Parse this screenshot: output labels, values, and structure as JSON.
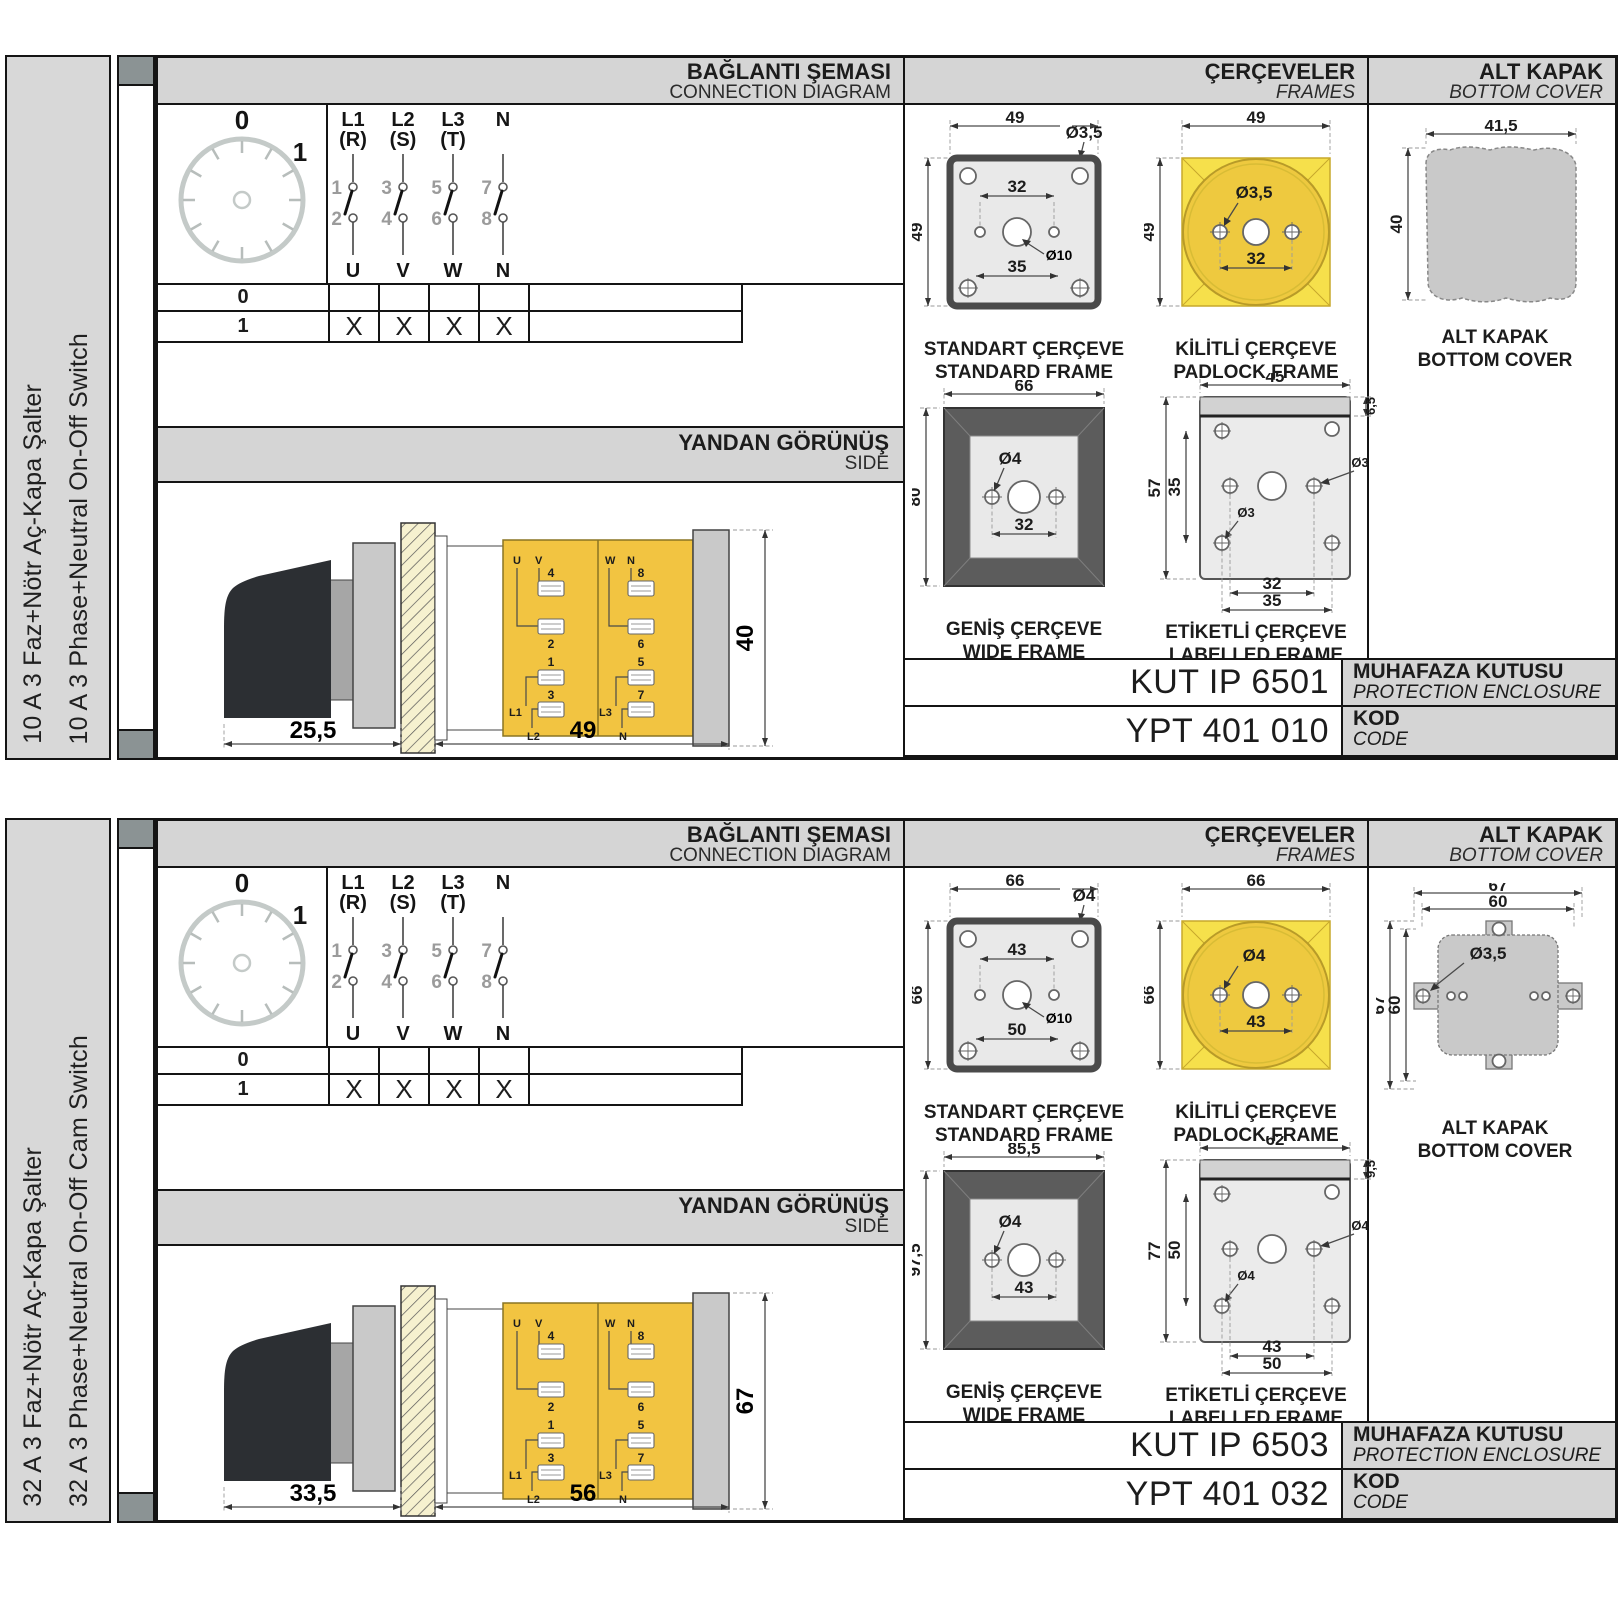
{
  "page": {
    "background": "#ffffff"
  },
  "shared": {
    "headers": {
      "connection_tr": "BAĞLANTI ŞEMASI",
      "connection_en": "CONNECTION DIAGRAM",
      "frames_tr": "ÇERÇEVELER",
      "frames_en": "FRAMES",
      "bottom_cover_tr": "ALT KAPAK",
      "bottom_cover_en": "BOTTOM COVER",
      "side_tr": "YANDAN GÖRÜNÜŞ",
      "side_en": "SIDE",
      "enclosure_tr": "MUHAFAZA KUTUSU",
      "enclosure_en": "PROTECTION ENCLOSURE",
      "code_tr": "KOD",
      "code_en": "CODE"
    },
    "dial": {
      "pos0": "0",
      "pos1": "1"
    },
    "contacts": {
      "columns": [
        {
          "phase": "L1",
          "alt": "(R)",
          "top": "1",
          "bottom": "2",
          "out": "U"
        },
        {
          "phase": "L2",
          "alt": "(S)",
          "top": "3",
          "bottom": "4",
          "out": "V"
        },
        {
          "phase": "L3",
          "alt": "(T)",
          "top": "5",
          "bottom": "6",
          "out": "W"
        },
        {
          "phase": "N",
          "alt": "",
          "top": "7",
          "bottom": "8",
          "out": "N"
        }
      ]
    },
    "table": {
      "rows": [
        {
          "pos": "0",
          "marks": [
            "",
            "",
            "",
            ""
          ]
        },
        {
          "pos": "1",
          "marks": [
            "X",
            "X",
            "X",
            "X"
          ]
        }
      ]
    },
    "side_terminals": {
      "u": "U",
      "v": "V",
      "w": "W",
      "n": "N",
      "t4": "4",
      "t8": "8",
      "t2": "2",
      "t6": "6",
      "t1": "1",
      "t5": "5",
      "t3": "3",
      "t7": "7",
      "l1": "L1",
      "l2": "L2",
      "l3": "L3",
      "n2": "N"
    },
    "captions": {
      "standard_tr": "STANDART ÇERÇEVE",
      "standard_en": "STANDARD FRAME",
      "padlock_tr": "KİLİTLİ ÇERÇEVE",
      "padlock_en": "PADLOCK FRAME",
      "wide_tr": "GENİŞ ÇERÇEVE",
      "wide_en": "WIDE FRAME",
      "labelled_tr": "ETİKETLİ ÇERÇEVE",
      "labelled_en": "LABELLED FRAME",
      "cover_tr": "ALT KAPAK",
      "cover_en": "BOTTOM COVER"
    },
    "colors": {
      "yellow_frame": "#f6e04b",
      "yellow_circle": "#eec93f",
      "yellow_body": "#f2c441",
      "header_gray": "#d5d5d5",
      "cap_gray": "#8b9394",
      "dark_frame": "#5c5c5c"
    }
  },
  "panels": [
    {
      "label_tr": "10 A 3 Faz+Nötr Aç-Kapa Şalter",
      "label_en": "10 A 3 Phase+Neutral On-Off Switch",
      "side_view": {
        "depth": "25,5",
        "length": "49",
        "height": "40"
      },
      "frames": {
        "standard": {
          "w": "49",
          "h": "49",
          "hole": "Ø3,5",
          "span": "32",
          "center": "Ø10",
          "bottom": "35"
        },
        "padlock": {
          "w": "49",
          "h": "49",
          "hole": "Ø3,5",
          "span": "32"
        },
        "wide": {
          "w": "66",
          "h": "80",
          "hole": "Ø4",
          "span": "32"
        },
        "labelled": {
          "w": "45",
          "strip": "6,5",
          "h": "57",
          "vspan": "35",
          "hole_r": "Ø3",
          "hole_b": "Ø3",
          "span1": "32",
          "span2": "35"
        }
      },
      "cover": {
        "w": "41,5",
        "h": "40",
        "w2": "",
        "h2": "",
        "hole": ""
      },
      "enclosure_code": "KUT IP 6501",
      "order_code": "YPT 401 010"
    },
    {
      "label_tr": "32 A 3 Faz+Nötr Aç-Kapa Şalter",
      "label_en": "32 A 3 Phase+Neutral On-Off Cam Switch",
      "side_view": {
        "depth": "33,5",
        "length": "56",
        "height": "67"
      },
      "frames": {
        "standard": {
          "w": "66",
          "h": "66",
          "hole": "Ø4",
          "span": "43",
          "center": "Ø10",
          "bottom": "50"
        },
        "padlock": {
          "w": "66",
          "h": "66",
          "hole": "Ø4",
          "span": "43"
        },
        "wide": {
          "w": "85,5",
          "h": "97,5",
          "hole": "Ø4",
          "span": "43"
        },
        "labelled": {
          "w": "62",
          "strip": "9,5",
          "h": "77",
          "vspan": "50",
          "hole_r": "Ø4",
          "hole_b": "Ø4",
          "span1": "43",
          "span2": "50"
        }
      },
      "cover": {
        "w": "67",
        "h": "67",
        "w2": "60",
        "h2": "60",
        "hole": "Ø3,5"
      },
      "enclosure_code": "KUT IP 6503",
      "order_code": "YPT 401 032"
    }
  ]
}
